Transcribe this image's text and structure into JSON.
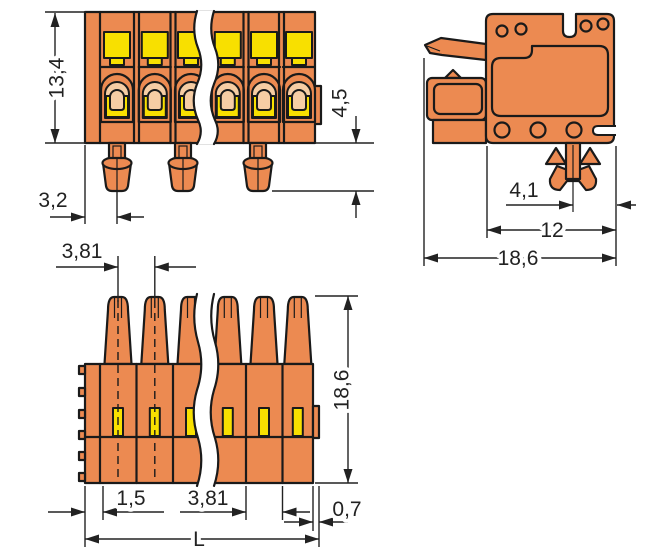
{
  "drawing": {
    "kind": "connector-technical-dimension-drawing",
    "units": "mm",
    "colors": {
      "body_orange": "#EC8A51",
      "spring_yellow": "#F8E000",
      "contact_tan": "#F6CDA4",
      "outline": "#1A1A1A",
      "dimension_lines": "#222222",
      "background": "#FFFFFF"
    },
    "views": {
      "front_view": {
        "dims": {
          "total_height": "13,4",
          "edge_to_first_foot": "3,2",
          "foot_length": "4,5"
        }
      },
      "side_view": {
        "dims": {
          "foot_to_rear_edge": "4,1",
          "body_depth": "12",
          "overall_depth": "18,6"
        }
      },
      "bottom_view": {
        "dims": {
          "pole_pitch_top": "3,81",
          "overall_height": "18,6",
          "edge_offset": "1,5",
          "pole_pitch": "3,81",
          "rib_offset": "0,7",
          "total_length": "L"
        }
      }
    }
  }
}
